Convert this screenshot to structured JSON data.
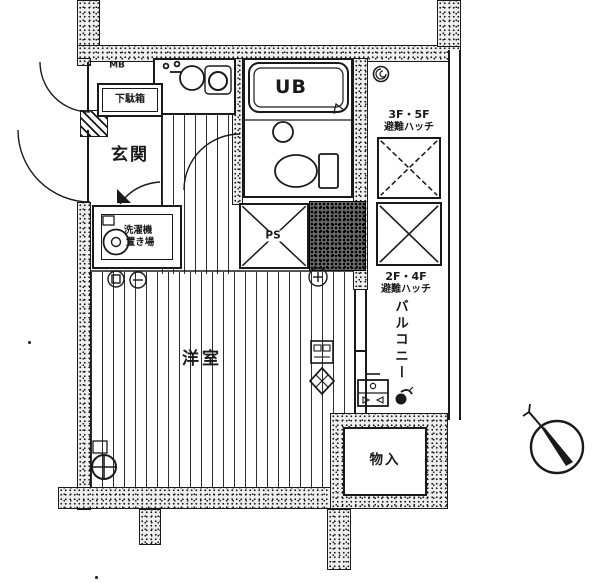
{
  "rooms": {
    "entrance": "玄関",
    "western_room": "洋室",
    "unit_bath": "UB",
    "storage": "物入",
    "pipe_space": "PS",
    "meter_box": "MB",
    "shoe_cabinet": "下駄箱",
    "washer_space_line1": "洗濯機",
    "washer_space_line2": "置き場",
    "balcony": "バルコニー"
  },
  "annotations": {
    "hatch_upper_floors": "3F・5F",
    "hatch_upper_label": "避難ハッチ",
    "hatch_lower_floors": "2F・4F",
    "hatch_lower_label": "避難ハッチ"
  },
  "colors": {
    "ink": "#1a1a1a",
    "paper": "#ffffff"
  }
}
